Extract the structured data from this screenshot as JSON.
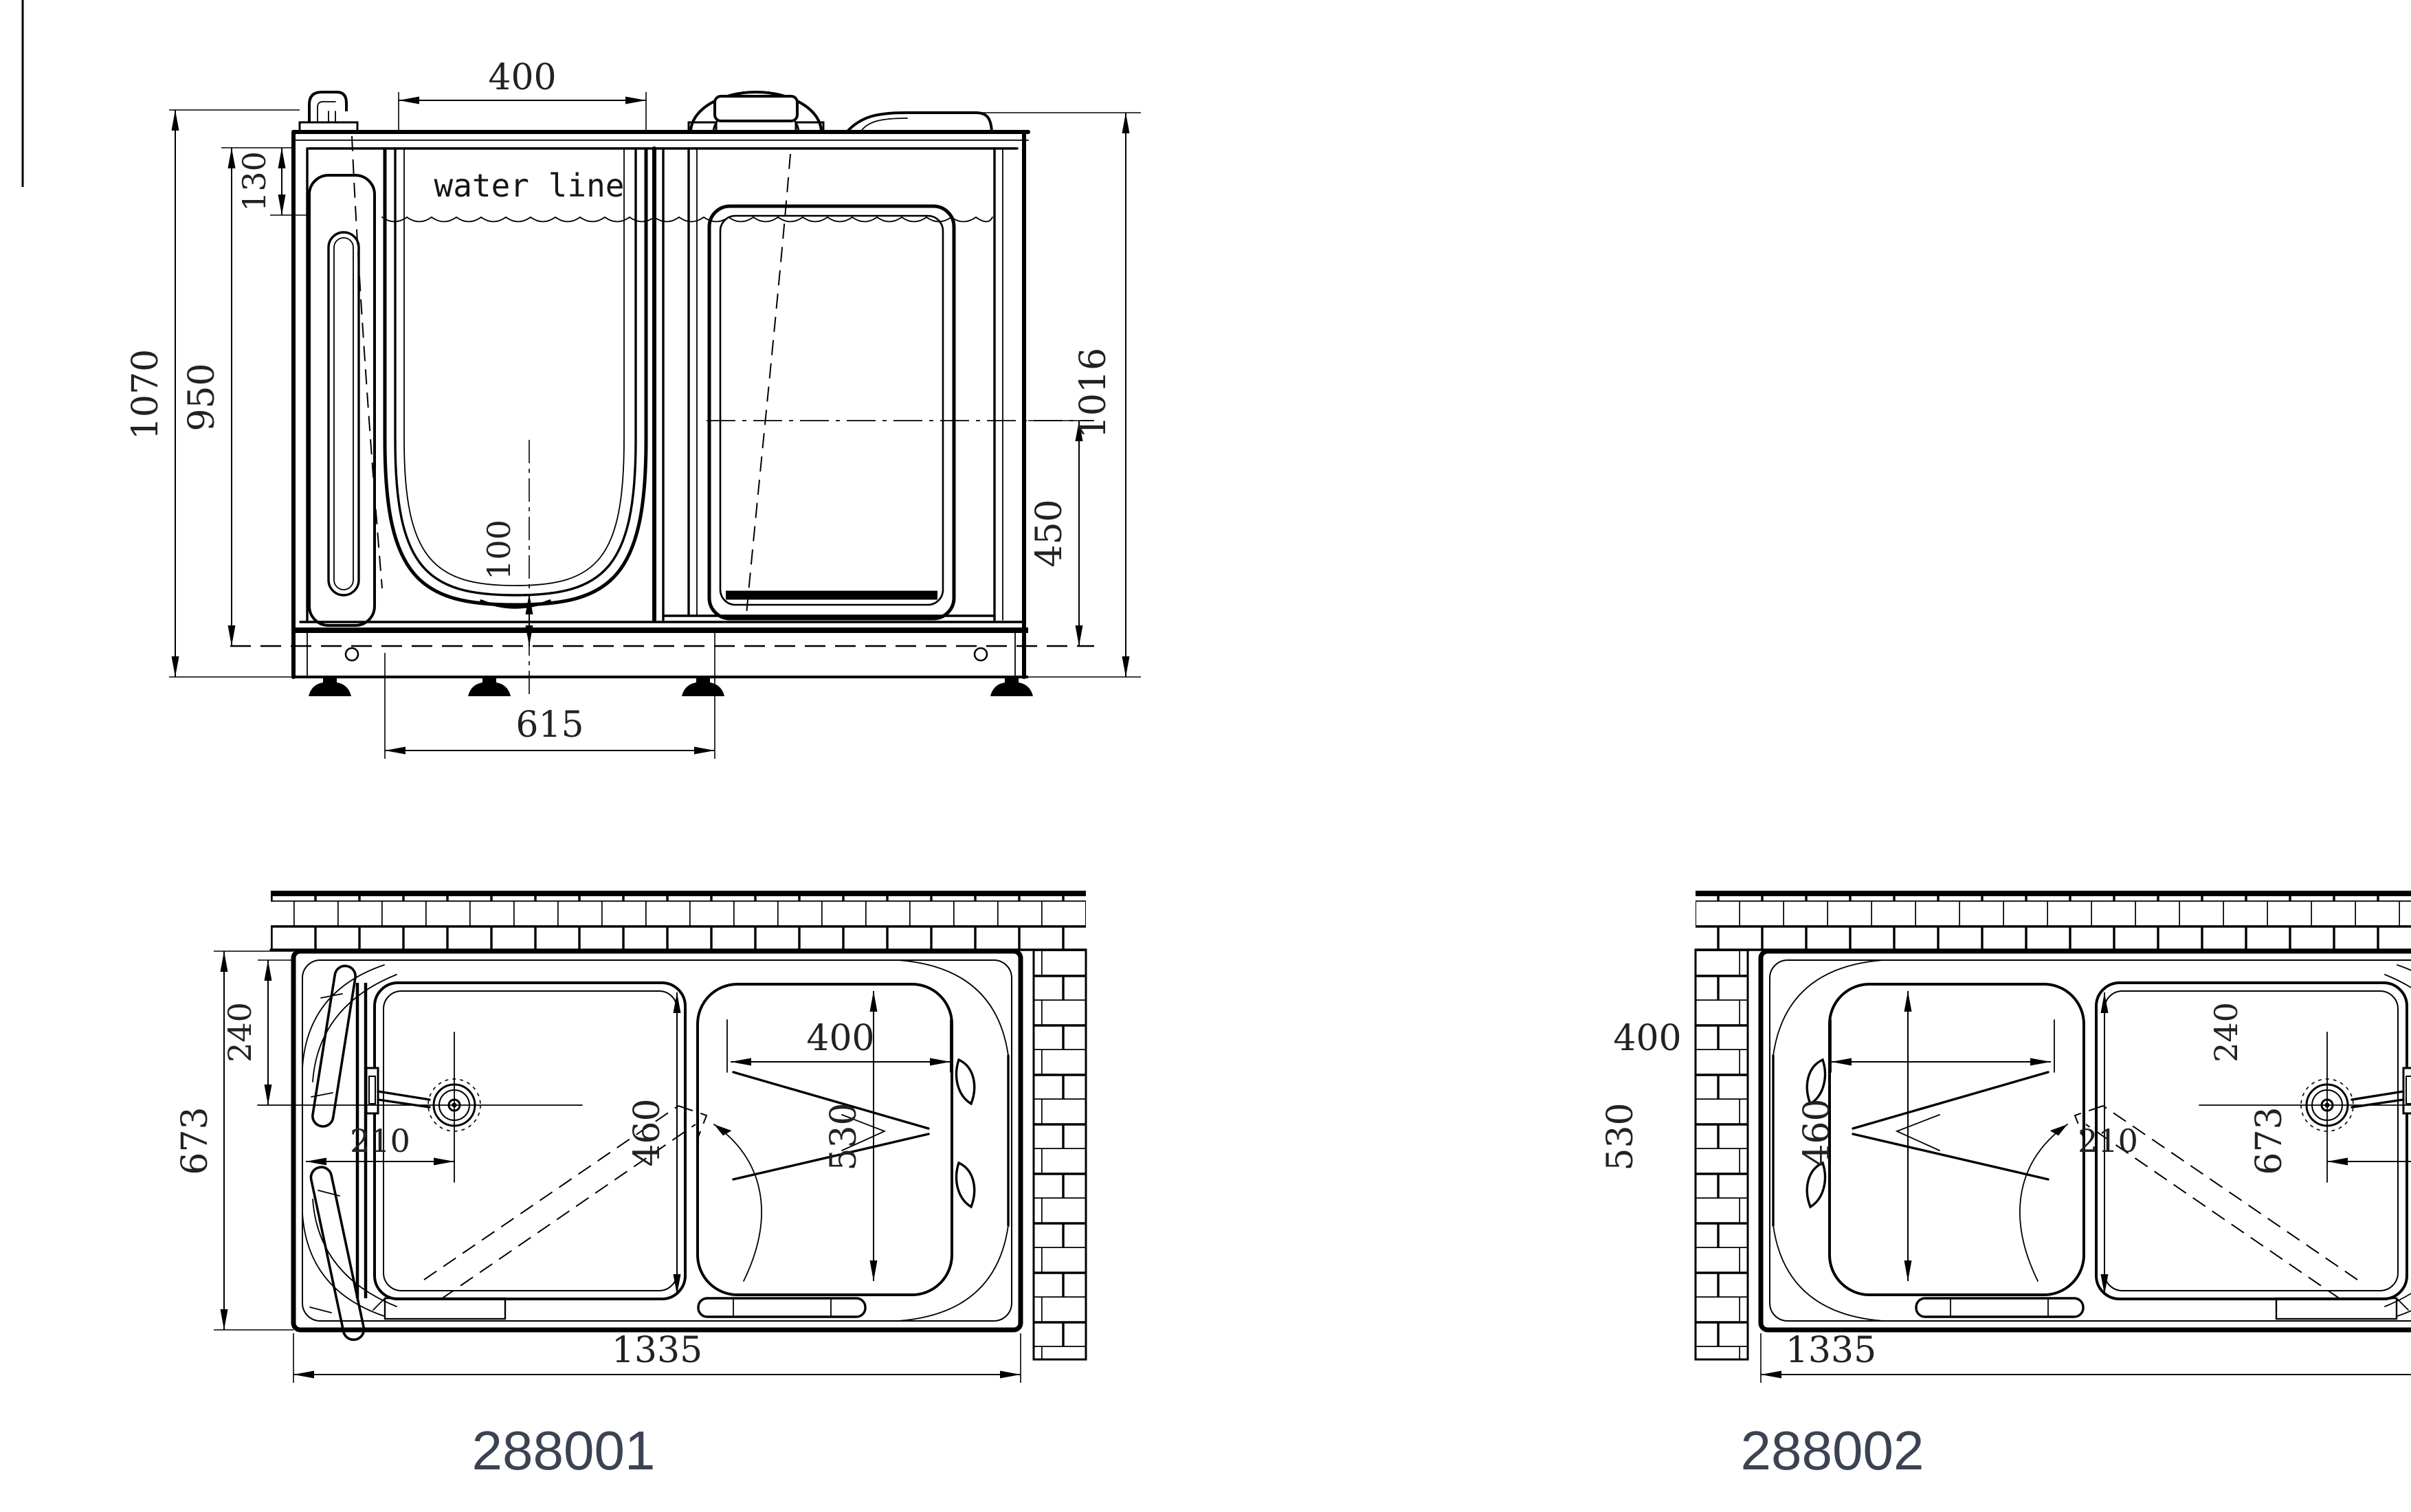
{
  "page": {
    "background": "#ffffff",
    "line_color": "#000000",
    "dim_text_color": "#222222",
    "model_text_color": "#3b4353"
  },
  "elevation": {
    "water_line_label": "water line",
    "dims": {
      "top_width": "400",
      "rim_to_waterline": "130",
      "inner_depth": "950",
      "overall_height": "1070",
      "sump_depth": "100",
      "drain_offset": "615",
      "seat_to_floor": "450",
      "wall_height": "1016"
    }
  },
  "plan_left": {
    "model": "288001",
    "dims": {
      "corner_to_drain": "240",
      "width": "673",
      "drain_offset": "210",
      "door_opening": "460",
      "seat_width": "400",
      "seat_depth": "530",
      "length": "1335"
    }
  },
  "plan_right": {
    "model": "288002",
    "dims": {
      "corner_to_drain": "240",
      "width": "673",
      "drain_offset": "210",
      "door_opening": "460",
      "seat_width": "400",
      "seat_depth": "530",
      "length": "1335"
    }
  }
}
